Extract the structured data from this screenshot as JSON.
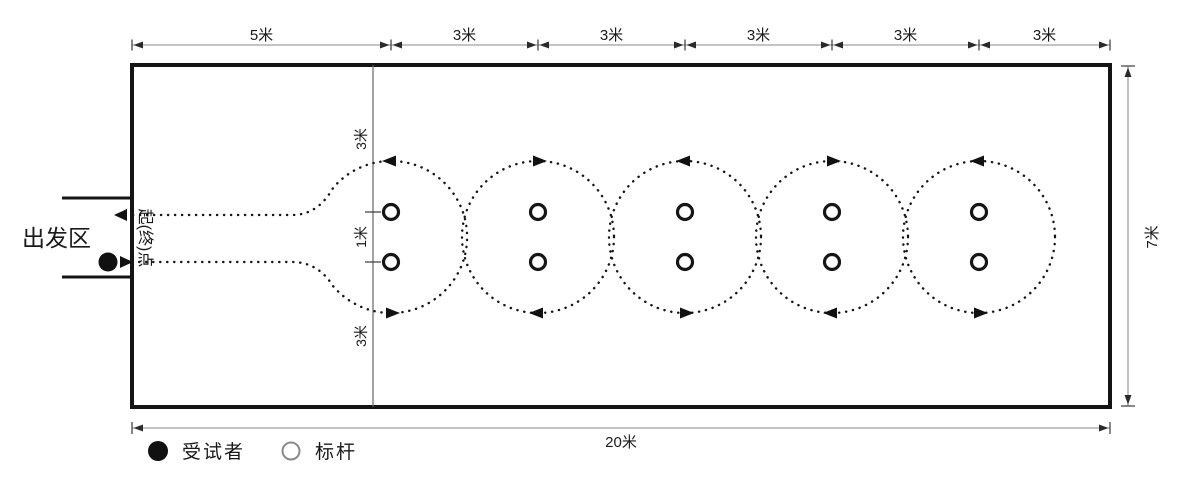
{
  "field": {
    "width_label": "20米",
    "height_label": "7米"
  },
  "top_dimensions": {
    "segments": [
      "5米",
      "3米",
      "3米",
      "3米",
      "3米",
      "3米"
    ]
  },
  "start_line_dimensions": {
    "top": "3米",
    "middle": "1米",
    "bottom": "3米"
  },
  "start": {
    "area_label": "出发区",
    "line_label": "起(终)点"
  },
  "legend": {
    "subject": {
      "symbol": "filled-circle",
      "label": "受试者"
    },
    "pole": {
      "symbol": "open-circle",
      "label": "标杆"
    }
  },
  "course": {
    "circle_count": 5,
    "poles_per_circle": 2,
    "circles": [
      {
        "direction": "counterclockwise"
      },
      {
        "direction": "clockwise"
      },
      {
        "direction": "counterclockwise"
      },
      {
        "direction": "clockwise"
      },
      {
        "direction": "counterclockwise"
      }
    ]
  },
  "colors": {
    "ink": "#1a1a1a",
    "dim_line": "#8a8a8a",
    "background": "#ffffff"
  }
}
